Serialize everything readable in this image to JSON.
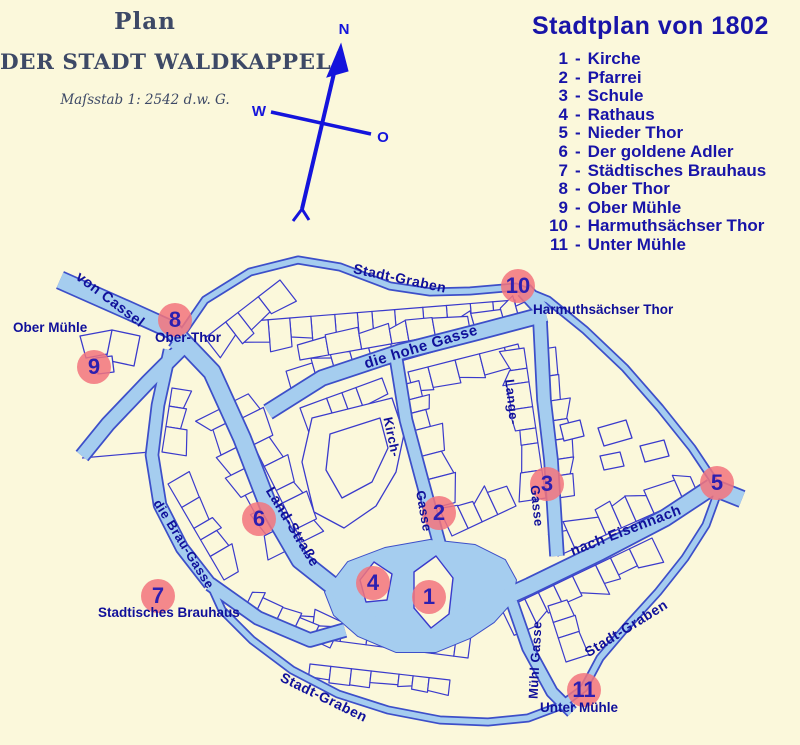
{
  "scan_title": {
    "line1": "Plan",
    "line2": "DER STADT WALDKAPPEL",
    "line3": "Maſsstab 1: 2542 d.w. G."
  },
  "compass": {
    "north": "N",
    "west": "W",
    "east": "O"
  },
  "legend": {
    "title": "Stadtplan von 1802",
    "separator": "-",
    "items": [
      {
        "num": "1",
        "label": "Kirche"
      },
      {
        "num": "2",
        "label": "Pfarrei"
      },
      {
        "num": "3",
        "label": "Schule"
      },
      {
        "num": "4",
        "label": "Rathaus"
      },
      {
        "num": "5",
        "label": "Nieder Thor"
      },
      {
        "num": "6",
        "label": "Der goldene Adler"
      },
      {
        "num": "7",
        "label": "Städtisches Brauhaus"
      },
      {
        "num": "8",
        "label": "Ober Thor"
      },
      {
        "num": "9",
        "label": "Ober Mühle"
      },
      {
        "num": "10",
        "label": "Harmuthsächser Thor"
      },
      {
        "num": "11",
        "label": "Unter Mühle"
      }
    ]
  },
  "map": {
    "markers": [
      {
        "num": "1",
        "x": 429,
        "y": 597
      },
      {
        "num": "2",
        "x": 439,
        "y": 513
      },
      {
        "num": "3",
        "x": 547,
        "y": 484
      },
      {
        "num": "4",
        "x": 373,
        "y": 583
      },
      {
        "num": "5",
        "x": 717,
        "y": 483
      },
      {
        "num": "6",
        "x": 259,
        "y": 519
      },
      {
        "num": "7",
        "x": 158,
        "y": 596
      },
      {
        "num": "8",
        "x": 175,
        "y": 320
      },
      {
        "num": "9",
        "x": 94,
        "y": 367
      },
      {
        "num": "10",
        "x": 518,
        "y": 286
      },
      {
        "num": "11",
        "x": 584,
        "y": 690
      }
    ],
    "street_labels": [
      {
        "text": "von Cassel",
        "x": 110,
        "y": 300,
        "rotate": 37,
        "size": 14.5
      },
      {
        "text": "Stadt-Graben",
        "x": 400,
        "y": 278,
        "rotate": 12,
        "size": 14
      },
      {
        "text": "die hohe Gasse",
        "x": 421,
        "y": 347,
        "rotate": -17,
        "size": 15
      },
      {
        "text": "Kirch-",
        "x": 392,
        "y": 437,
        "rotate": 78,
        "size": 13
      },
      {
        "text": "Gasse",
        "x": 424,
        "y": 511,
        "rotate": 80,
        "size": 13
      },
      {
        "text": "Lange-",
        "x": 512,
        "y": 402,
        "rotate": 84,
        "size": 13
      },
      {
        "text": "Gasse",
        "x": 537,
        "y": 506,
        "rotate": 84,
        "size": 13
      },
      {
        "text": "Land-Straße",
        "x": 292,
        "y": 527,
        "rotate": 59,
        "size": 14.5
      },
      {
        "text": "die Brau-Gasse",
        "x": 184,
        "y": 544,
        "rotate": 58,
        "size": 13
      },
      {
        "text": "nach Eisennach",
        "x": 626,
        "y": 531,
        "rotate": -21,
        "size": 14.5
      },
      {
        "text": "Stadt-Graben",
        "x": 626,
        "y": 628,
        "rotate": -32,
        "size": 14
      },
      {
        "text": "Stadt-Graben",
        "x": 324,
        "y": 697,
        "rotate": 26,
        "size": 14
      },
      {
        "text": "Mühl Gasse",
        "x": 535,
        "y": 660,
        "rotate": -87,
        "size": 13
      }
    ],
    "place_labels": [
      {
        "text": "Ober Mühle",
        "x": 13,
        "y": 320
      },
      {
        "text": "Ober-Thor",
        "x": 155,
        "y": 330
      },
      {
        "text": "Harmuthsächser Thor",
        "x": 533,
        "y": 302
      },
      {
        "text": "Stadtisches Brauhaus",
        "x": 98,
        "y": 605
      },
      {
        "text": "Unter Mühle",
        "x": 540,
        "y": 700
      }
    ],
    "colors": {
      "background": "#FBF8DB",
      "road_fill": "#A5CDEF",
      "road_border": "#3D4FC9",
      "building_stroke": "#3A3ACC",
      "marker_fill": "#F2747C",
      "marker_text": "#2D1FB0",
      "label_text": "#10109A",
      "legend_text": "#1814A8",
      "compass": "#1414DC",
      "scan_text": "#3D4966"
    }
  }
}
